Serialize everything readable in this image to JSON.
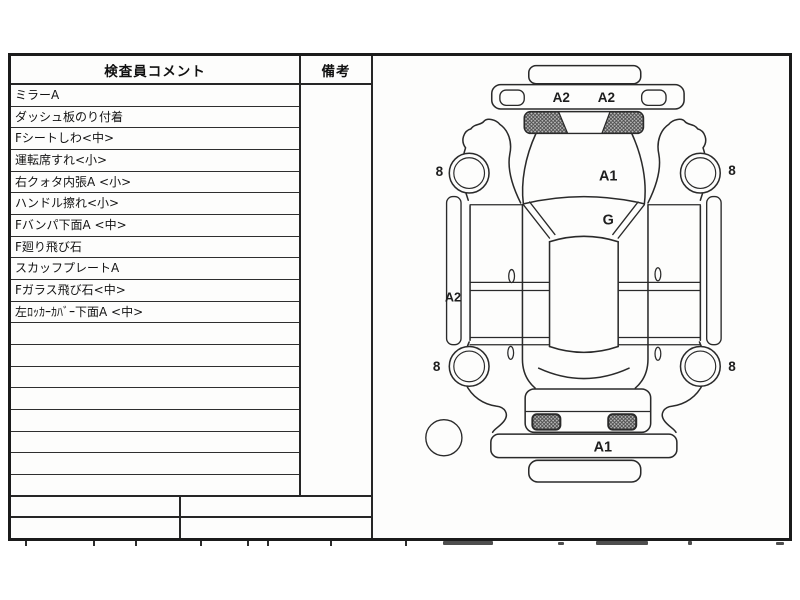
{
  "table": {
    "header": {
      "comments": "検査員コメント",
      "remarks": "備考"
    },
    "rows": [
      "ミラーA",
      "ダッシュ板のり付着",
      "Fシートしわ<中>",
      "運転席すれ<小>",
      "右クォタ内張A <小>",
      "ハンドル擦れ<小>",
      "Fバンパ下面A <中>",
      "F廻り飛び石",
      "スカッフプレートA",
      "Fガラス飛び石<中>",
      "左ﾛｯｶｰｶﾊﾞｰ下面A <中>"
    ],
    "empty_rows": 8
  },
  "diagram": {
    "front_labels": [
      "A2",
      "A2"
    ],
    "hood_label": "A1",
    "windshield_label": "G",
    "left_molding_label": "A2",
    "rear_bumper_label": "A1",
    "wheel_labels": [
      "8",
      "8",
      "8",
      "8"
    ],
    "ink_color": "#2a2a2a"
  }
}
